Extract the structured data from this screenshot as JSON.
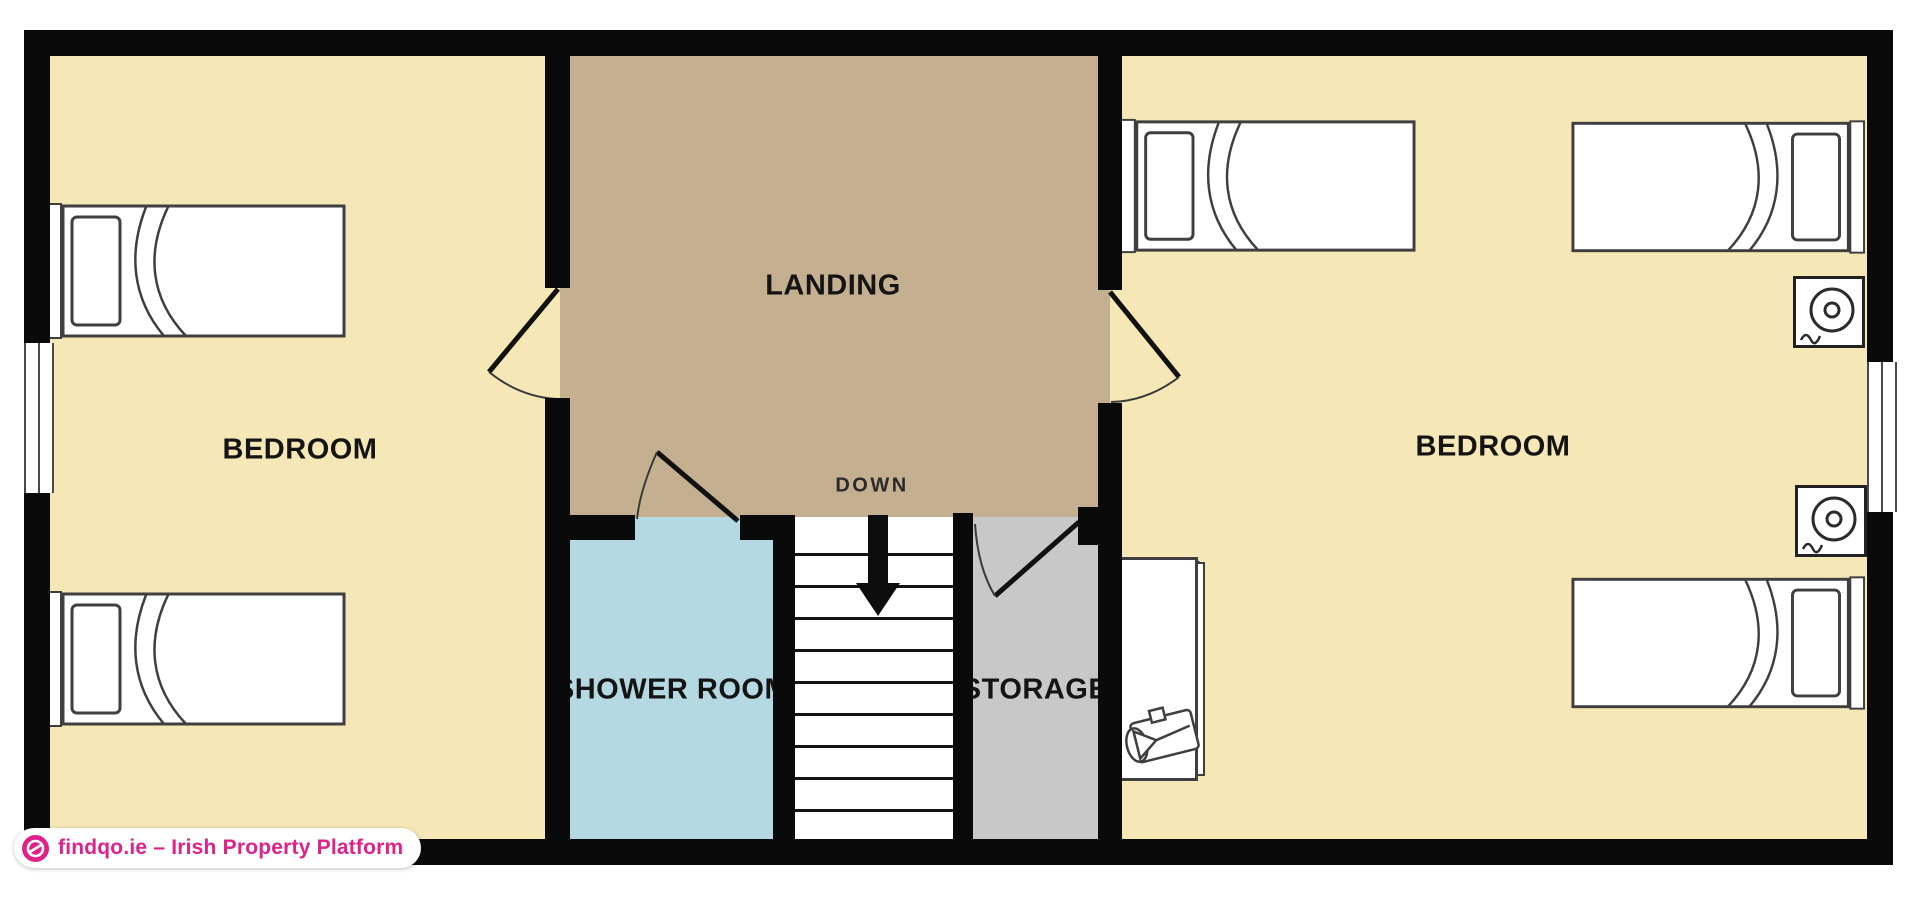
{
  "plan": {
    "colors": {
      "wall": "#0a0a0a",
      "bedroom_fill": "#f5e7b6",
      "landing_fill": "#c5af91",
      "shower_fill": "#b5d9e2",
      "storage_fill": "#c8c8c8",
      "stair_fill": "#ffffff",
      "furniture_outline": "#3f3f3f",
      "accent": "#e0218a"
    },
    "rooms": {
      "left_bedroom": {
        "label": "BEDROOM"
      },
      "right_bedroom": {
        "label": "BEDROOM"
      },
      "landing": {
        "label": "LANDING"
      },
      "shower_room": {
        "label": "SHOWER ROOM"
      },
      "storage": {
        "label": "STORAGE"
      }
    },
    "stairs": {
      "direction_label": "DOWN",
      "tread_count": 9
    }
  },
  "badge": {
    "text": "findqo.ie – Irish Property Platform",
    "icon": "globe"
  }
}
